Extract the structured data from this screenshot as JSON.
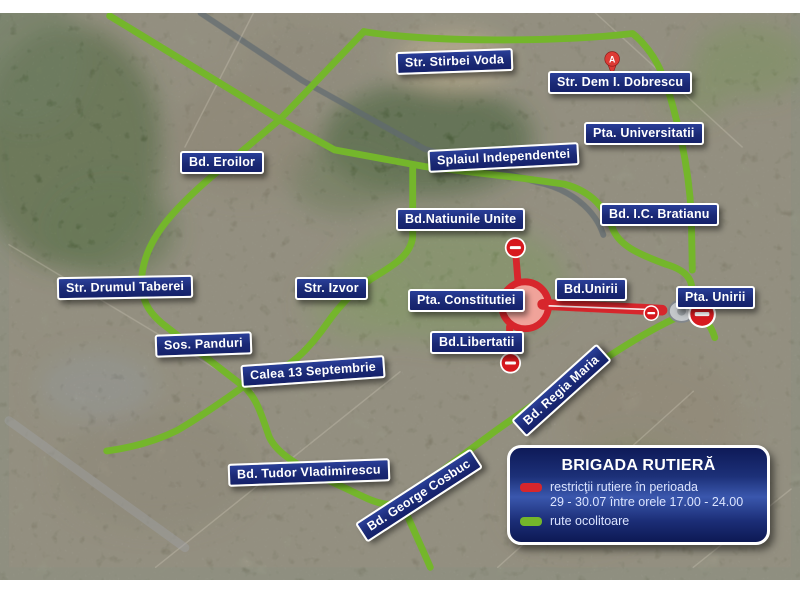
{
  "map": {
    "street_labels": {
      "stirbei_voda": "Str. Stirbei Voda",
      "dem_dobrescu": "Str. Dem I. Dobrescu",
      "universitatii": "Pta. Universitatii",
      "eroilor": "Bd. Eroilor",
      "splaiul_independentei": "Splaiul Independentei",
      "ic_bratianu": "Bd. I.C. Bratianu",
      "natiunile_unite": "Bd.Natiunile Unite",
      "drumul_taberei": "Str. Drumul Taberei",
      "izvor": "Str. Izvor",
      "constitutiei": "Pta. Constitutiei",
      "unirii_bd": "Bd.Unirii",
      "unirii_pta": "Pta. Unirii",
      "panduri": "Sos. Panduri",
      "libertatii": "Bd.Libertatii",
      "calea_13_septembrie": "Calea 13 Septembrie",
      "regia_maria": "Bd. Regia Maria",
      "tudor_vladimirescu": "Bd. Tudor Vladimirescu",
      "george_cosbuc": "Bd. George Cosbuc"
    },
    "marker_a_label": "A",
    "colors": {
      "restricted_route": "#d7262c",
      "detour_route": "#74b62b",
      "label_background": "#1b2a76"
    }
  },
  "legend": {
    "title": "BRIGADA RUTIERĂ",
    "restricted_line1": "restricţii rutiere în perioada",
    "restricted_line2": "29 - 30.07 între orele 17.00 - 24.00",
    "detour_label": "rute ocolitoare",
    "restricted_color": "#d7262c",
    "detour_color": "#74b62b"
  }
}
